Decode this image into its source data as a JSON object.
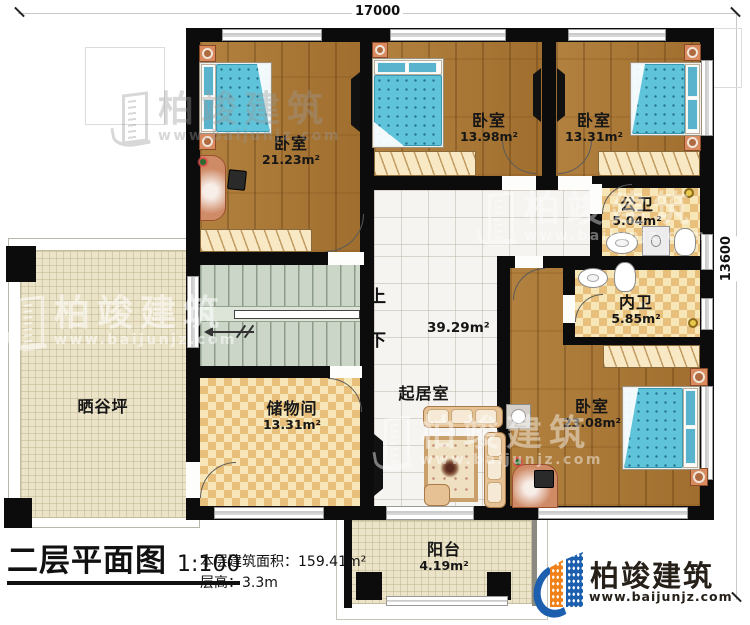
{
  "plan": {
    "dimensions": {
      "width_mm": "17000",
      "height_mm": "13600"
    },
    "rooms": [
      {
        "id": "bedroom-top-left",
        "name": "卧室",
        "area": "21.23m²"
      },
      {
        "id": "bedroom-top-middle",
        "name": "卧室",
        "area": "13.98m²"
      },
      {
        "id": "bedroom-top-right",
        "name": "卧室",
        "area": "13.31m²"
      },
      {
        "id": "public-bathroom",
        "name": "公卫",
        "area": "5.04m²"
      },
      {
        "id": "private-bathroom",
        "name": "内卫",
        "area": "5.85m²"
      },
      {
        "id": "bedroom-bottom-right",
        "name": "卧室",
        "area": "23.08m²"
      },
      {
        "id": "storage-room",
        "name": "储物间",
        "area": "13.31m²"
      },
      {
        "id": "living-room",
        "name": "起居室",
        "area": "39.29m²"
      },
      {
        "id": "grain-drying-yard",
        "name": "晒谷坪",
        "area": ""
      },
      {
        "id": "balcony",
        "name": "阳台",
        "area": "4.19m²"
      }
    ],
    "stairs": {
      "up_label": "上",
      "down_label": "下"
    }
  },
  "footer": {
    "plan_title": "二层平面图",
    "scale": "1:100",
    "floor_area_label": "本层建筑面积：",
    "floor_area_value": "159.41m²",
    "floor_height_label": "层高：",
    "floor_height_value": "3.3m"
  },
  "brand": {
    "name": "柏竣建筑",
    "website": "www.baijunjz.com"
  },
  "watermark": {
    "name": "柏竣建筑",
    "website": "www.baijunjz.com"
  },
  "colors": {
    "wall": "#0c0c0c",
    "wood_floor": "#ad7a38",
    "bath_tile_light": "#f7e6b8",
    "bath_tile_dark": "#e8c07c",
    "paving": "#ece4c9",
    "stairs": "#ccd6c8",
    "mattress": "#5fc3da",
    "logo_blue": "#1b5fae",
    "logo_orange": "#f08119"
  }
}
